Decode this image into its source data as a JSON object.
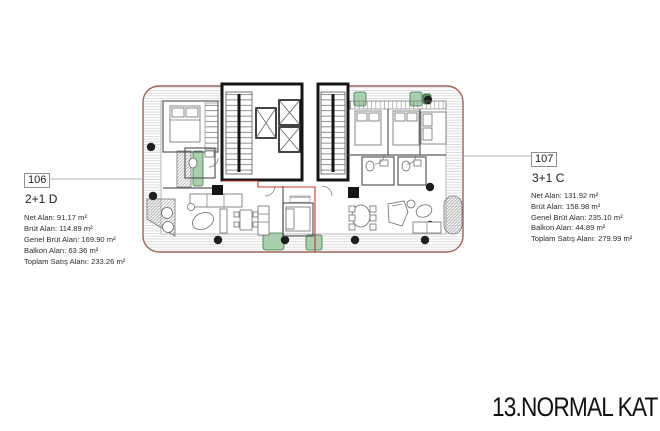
{
  "title": {
    "text": "13.NORMAL KAT"
  },
  "units": [
    {
      "number": "106",
      "type": "2+1 D",
      "areas": [
        "Net Alan: 91.17 m²",
        "Brüt Alan: 114.89 m²",
        "Genel Brüt Alan: 169.90 m²",
        "Balkon Alan: 63.36 m²",
        "Toplam Satış Alanı: 233.26 m²"
      ]
    },
    {
      "number": "107",
      "type": "3+1 C",
      "areas": [
        "Net Alan: 131.92 m²",
        "Brüt Alan: 158.98 m²",
        "Genel Brüt Alan: 235.10 m²",
        "Balkon Alan: 44.89 m²",
        "Toplam Satış Alanı: 279.99 m²"
      ]
    }
  ],
  "colors": {
    "building-outline": "#9c6457",
    "unit-boundary": "#c03a30",
    "planter-green": "#a9cfae",
    "planter-green-border": "#3f7249",
    "leader-line": "#b3b3b3"
  }
}
